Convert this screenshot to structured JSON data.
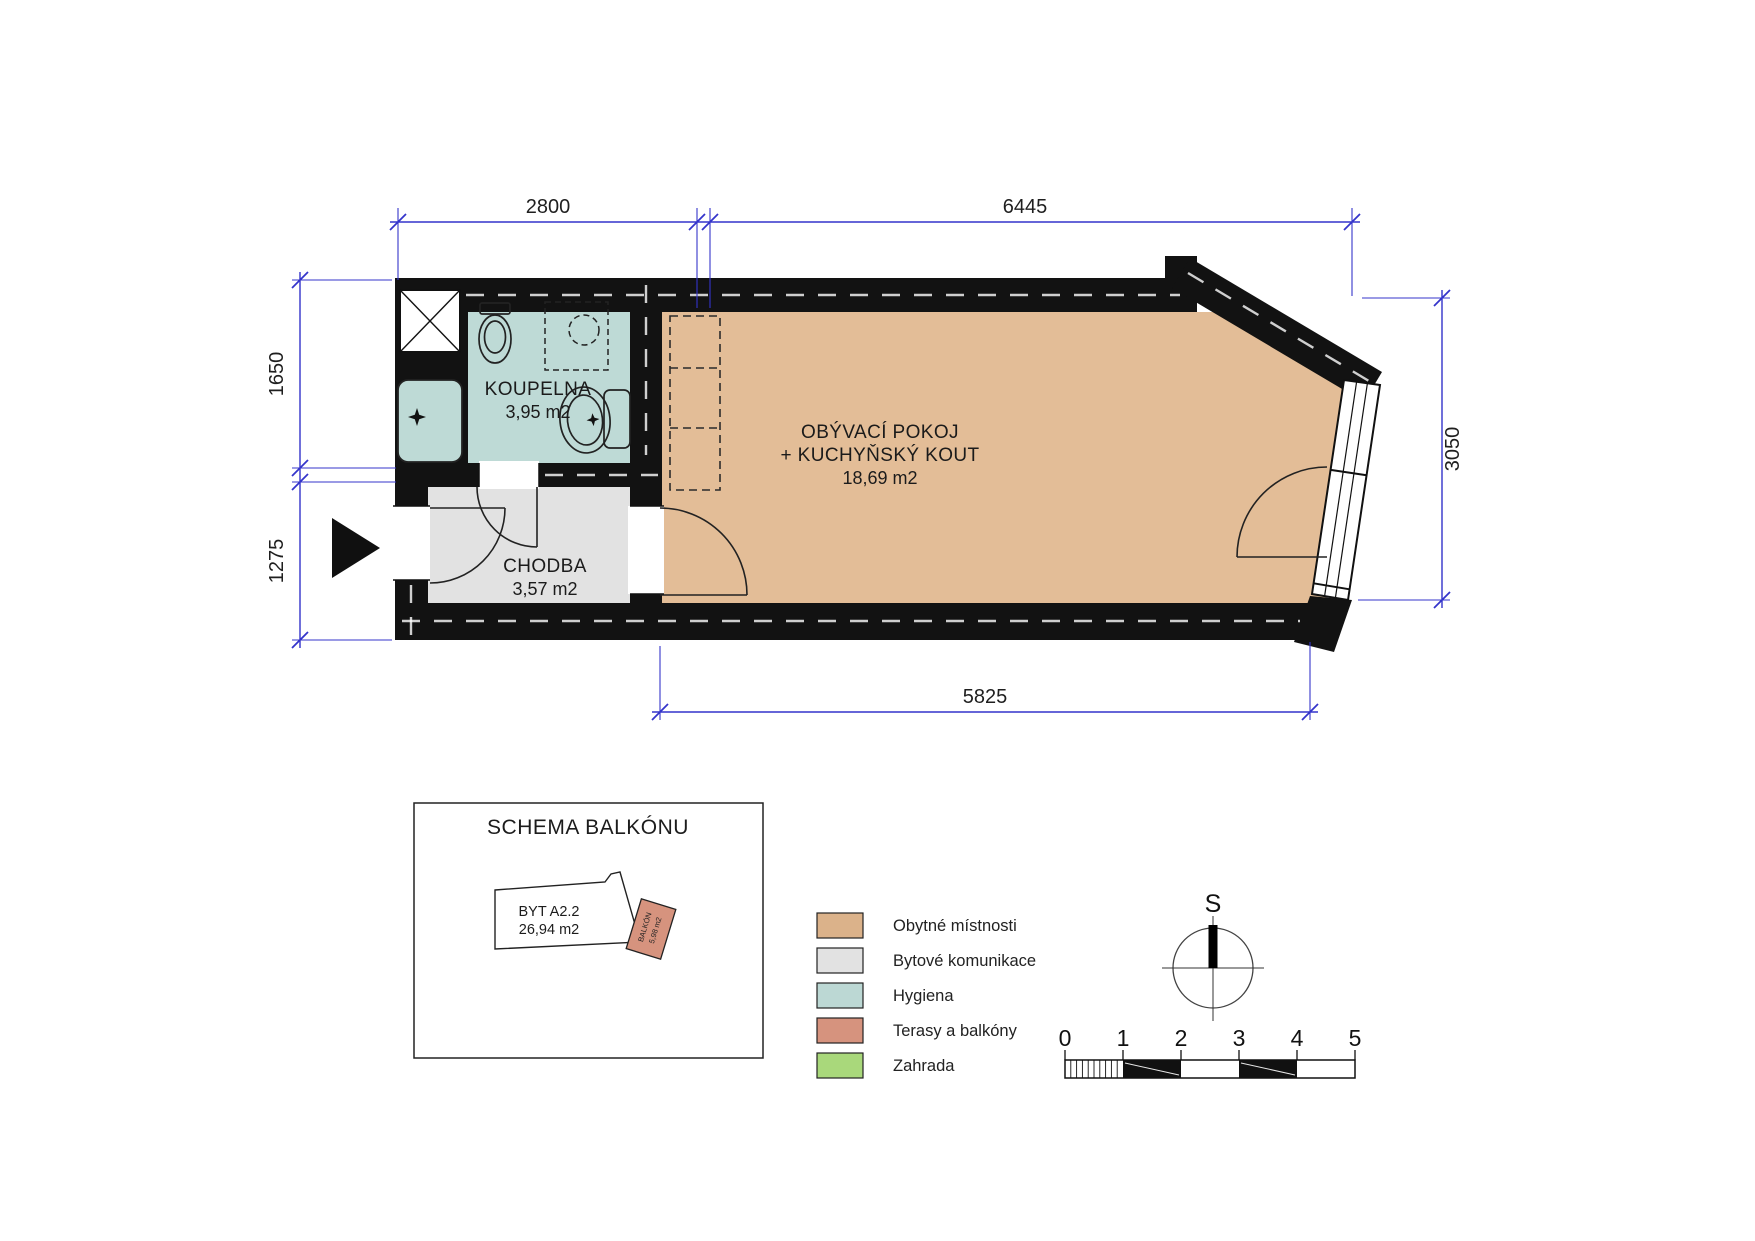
{
  "plan": {
    "rooms": {
      "koupelna": {
        "name": "KOUPELNA",
        "area": "3,95 m2"
      },
      "chodba": {
        "name": "CHODBA",
        "area": "3,57 m2"
      },
      "obyvaci": {
        "name": "OBÝVACÍ POKOJ",
        "name2": "+ KUCHYŇSKÝ KOUT",
        "area": "18,69 m2"
      }
    },
    "dimensions": {
      "top_left": "2800",
      "top_right": "6445",
      "left_upper": "1650",
      "left_lower": "1275",
      "right": "3050",
      "bottom": "5825"
    }
  },
  "schema": {
    "title": "SCHEMA BALKÓNU",
    "unit_label": "BYT A2.2",
    "unit_area": "26,94 m2",
    "balcony_label": "BALKÓN",
    "balcony_area": "5,98 m2"
  },
  "legend": {
    "items": [
      {
        "label": "Obytné místnosti",
        "color": "#dbb28a"
      },
      {
        "label": "Bytové komunikace",
        "color": "#e2e2e2"
      },
      {
        "label": "Hygiena",
        "color": "#bcd8d4"
      },
      {
        "label": "Terasy a balkóny",
        "color": "#d6937e"
      },
      {
        "label": "Zahrada",
        "color": "#a9d87b"
      }
    ]
  },
  "compass": {
    "north_label": "S"
  },
  "scalebar": {
    "labels": [
      "0",
      "1",
      "2",
      "3",
      "4",
      "5"
    ]
  },
  "colors": {
    "floor_living": "#e3bd97",
    "floor_hall": "#e2e2e2",
    "floor_bath": "#bedad6",
    "wall": "#121212",
    "dimension_blue": "#3434cb"
  }
}
